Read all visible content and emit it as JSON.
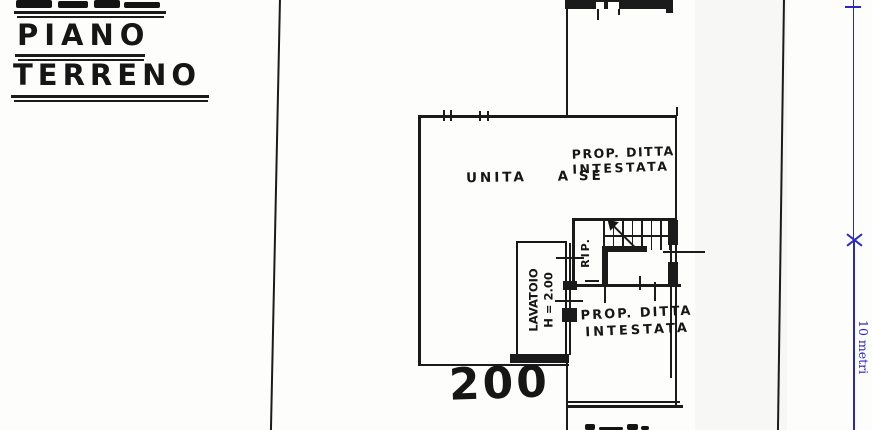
{
  "titles": {
    "piano": "PIANO",
    "terreno": "TERRENO"
  },
  "plan": {
    "unit_label": "UNITA    A SE",
    "neighbor_upper": {
      "line1": "PROP. DITTA",
      "line2": "INTESTATA"
    },
    "neighbor_lower": {
      "line1": "PROP. DITTA",
      "line2": "INTESTATA"
    },
    "lavatoio": {
      "name": "LAVATOIO",
      "height": "H = 2.00"
    },
    "stair_room": "RIP.",
    "parcel_number": "200"
  },
  "scale_bar": {
    "label": "10 metri"
  },
  "colors": {
    "ink": "#1a1a1a",
    "paper": "#fdfdfc",
    "accent_blue": "#2929c2"
  }
}
